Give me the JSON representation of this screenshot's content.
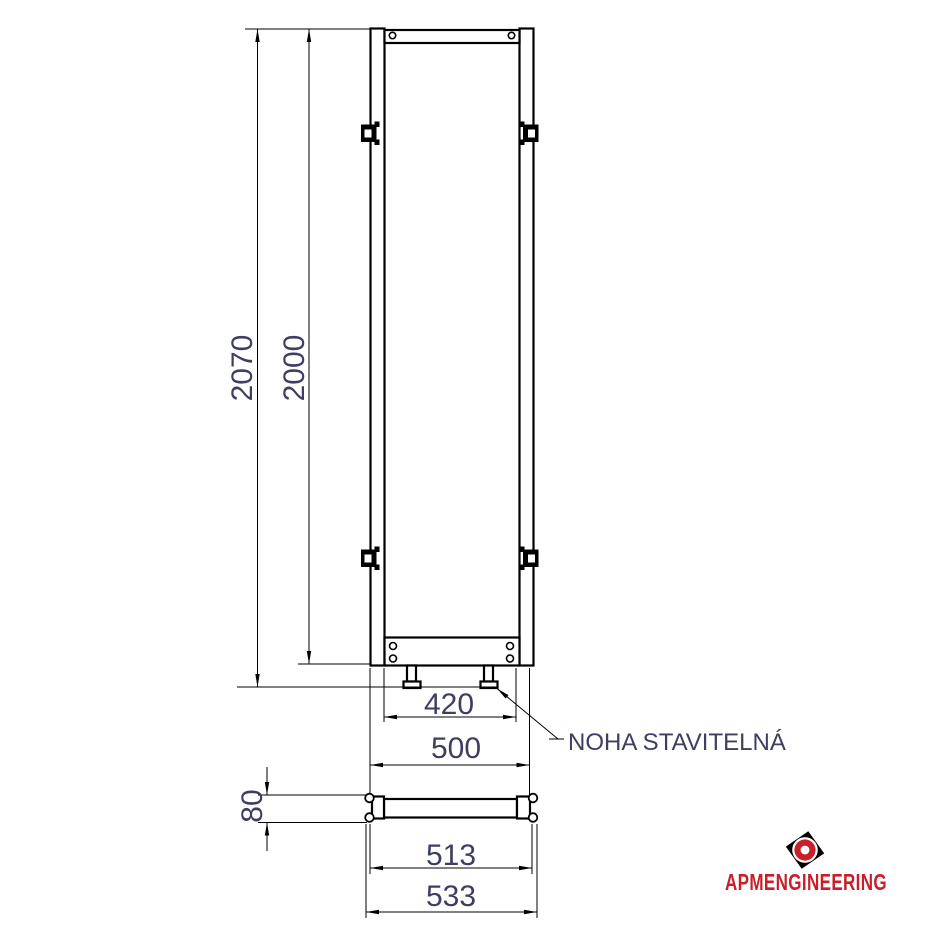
{
  "drawing": {
    "dims": {
      "total_height": "2070",
      "frame_height": "2000",
      "inner_width": "420",
      "outer_width": "500",
      "base_height": "80",
      "base_width_inner": "513",
      "base_width_outer": "533"
    },
    "labels": {
      "adjustable_foot": "NOHA STAVITELNÁ"
    },
    "logo": {
      "wordmark": "APMENGINEERING"
    },
    "colors": {
      "dim_text": "#3E3E63",
      "line": "#000000",
      "logo_red": "#C8202A"
    }
  }
}
